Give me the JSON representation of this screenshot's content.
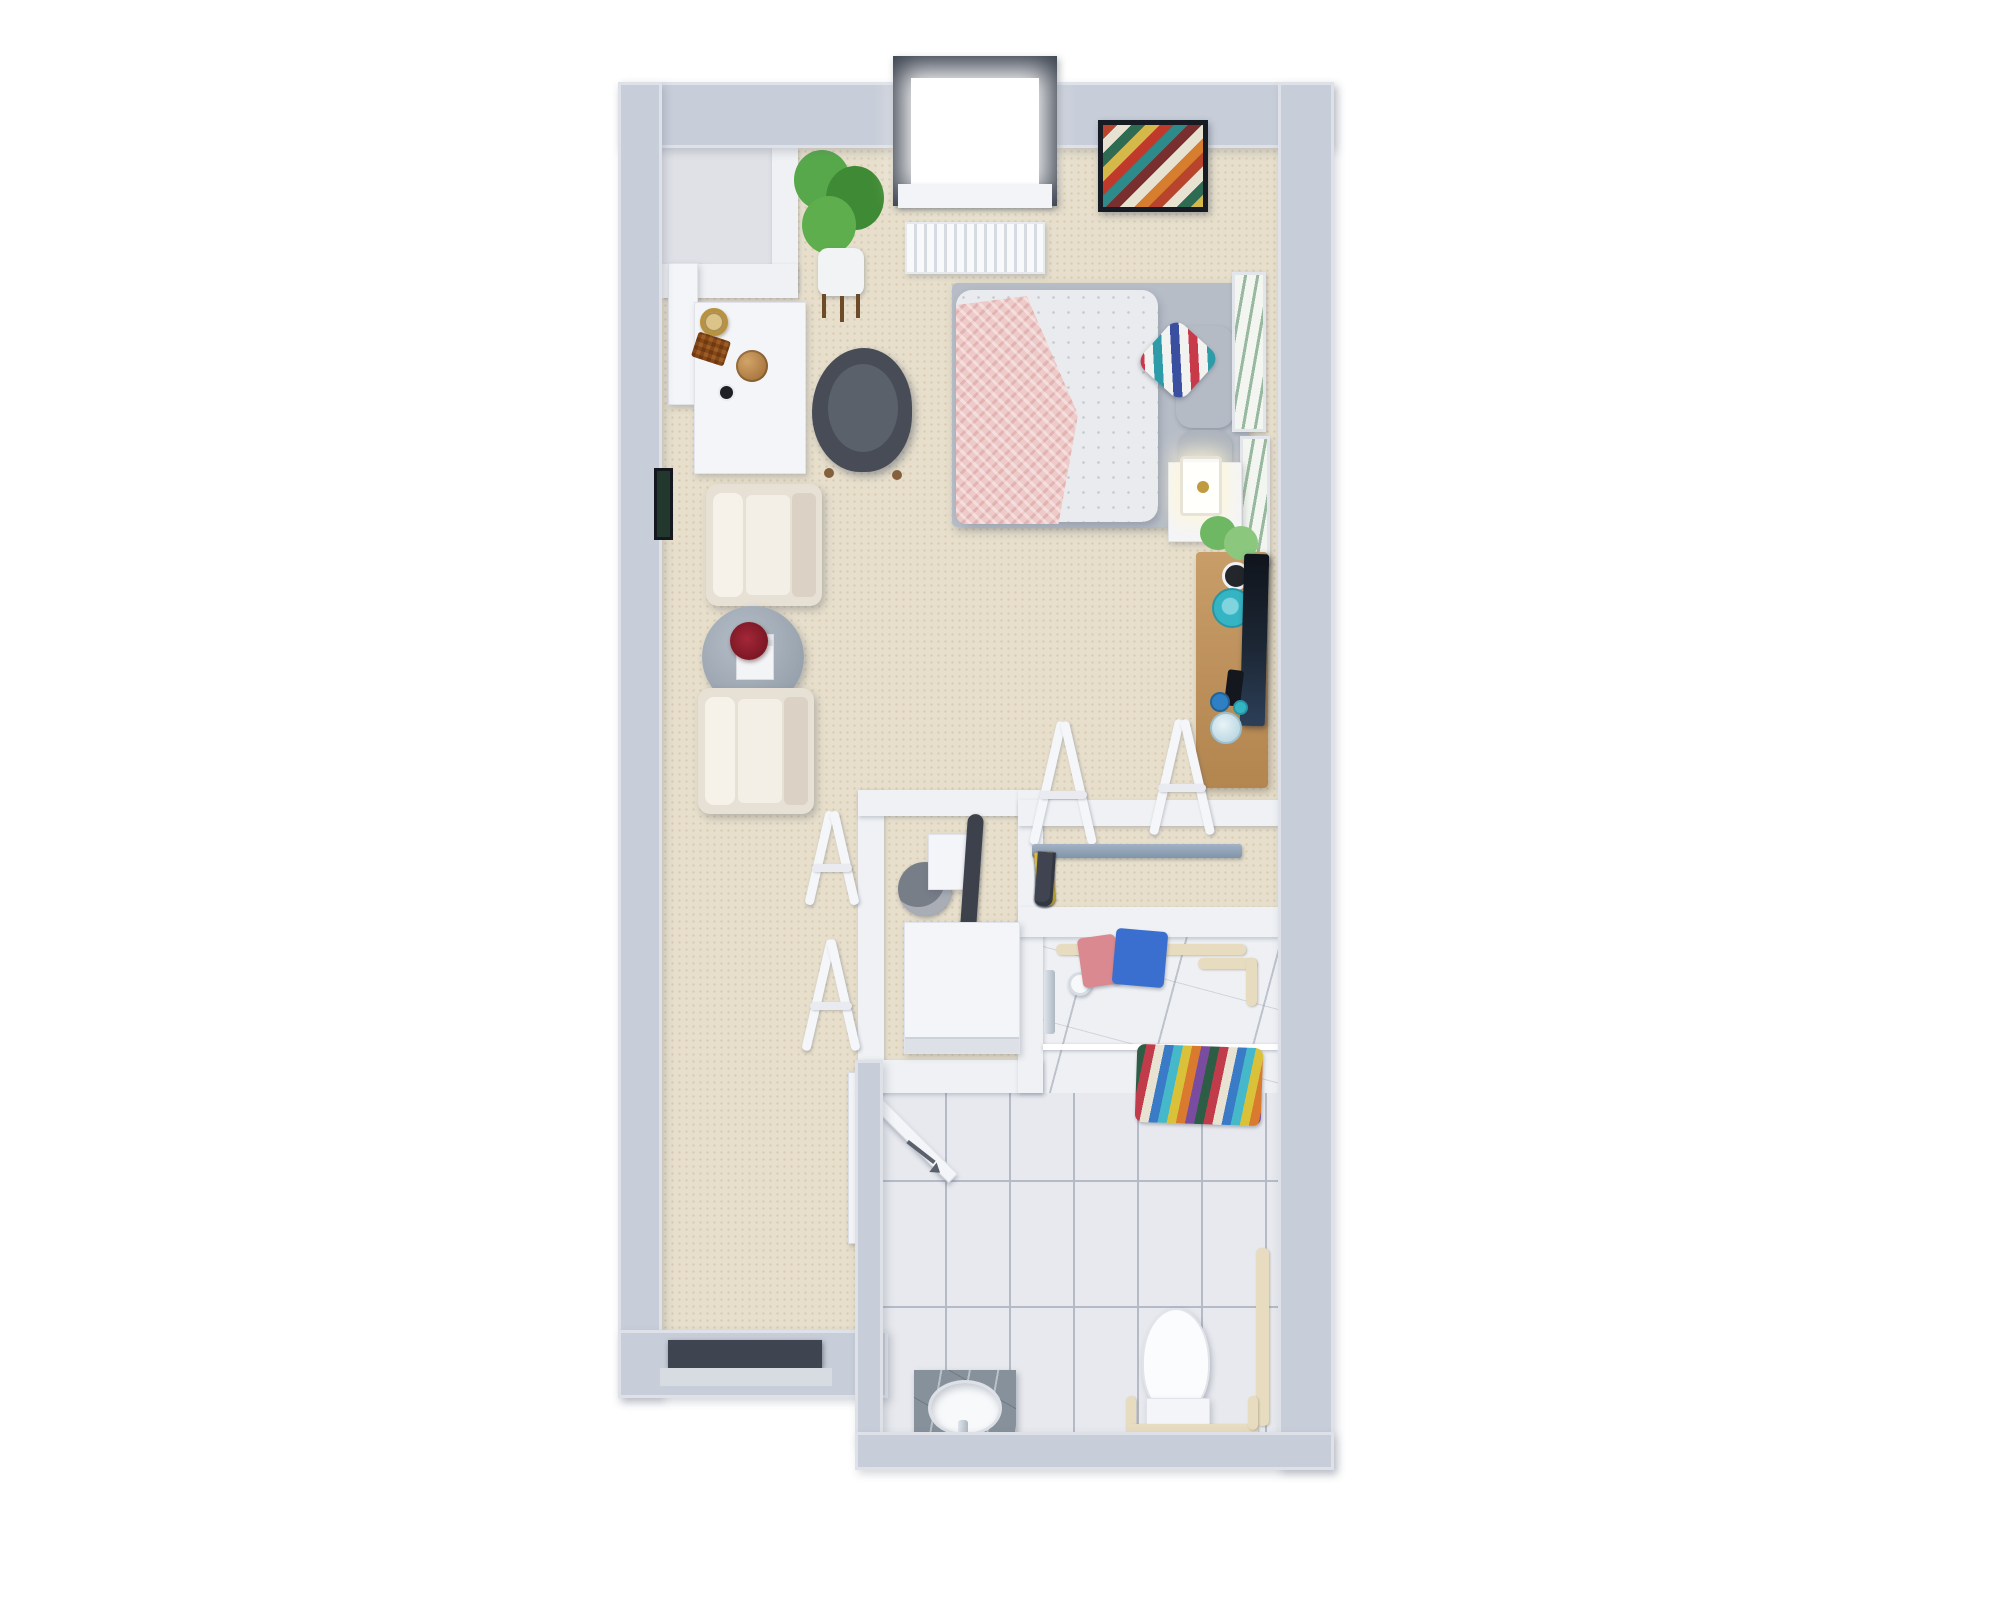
{
  "meta": {
    "title": "3D Studio Apartment Floor Plan",
    "view": "top-down 3D render, no visible text",
    "canvas": {
      "width": 2000,
      "height": 1600
    }
  },
  "palette": {
    "page-bg": "#ffffff",
    "wall": "#c8ced9",
    "wall-top": "#e9ebf0",
    "wall-white": "#eff1f4",
    "carpet": "#e7dfcc",
    "carpet-dot": "#d7cbb1",
    "nook-floor": "#dfe1e7",
    "tile": "#e7e9ee",
    "tile-joint": "#b4bac6",
    "marble": "#eef0f4",
    "wood": "#c2975f",
    "window-frame": "#39404d",
    "dark-door": "#3e4450",
    "teal": "#35b4c4",
    "blue": "#2f7fc4",
    "light-blue": "#cfe4ec",
    "pink-blanket": "#eecac8",
    "duvet": "#e9ebee",
    "gray-pillow": "#b5bbc5",
    "platform-gray": "#b7bdc7",
    "chair-dark": "#474c56",
    "cream-shell": "#e7e0d5",
    "cream-cushion": "#f4efe6",
    "flower-red": "#8e1f2c",
    "plant-green": "#4e9c40",
    "gold": "#b8923f",
    "white-furn": "#f4f5f8",
    "beige-bar": "#e8dcc0"
  },
  "rooms": [
    {
      "name": "Living & Sleeping Area",
      "floor": "beige carpet",
      "items": [
        "bed with dotted white duvet",
        "pink chunky-knit throw",
        "two gray pillows",
        "multicolor chevron accent pillow",
        "dark gray barrel armchair",
        "white desk",
        "brass basket",
        "woven brass tray",
        "bronze wire sphere",
        "black cup",
        "leaning mirror",
        "fiddle-leaf potted plant",
        "white panel radiator",
        "white nightstand",
        "brass lantern lamp",
        "wood media console",
        "flat-screen TV",
        "monstera plant",
        "teal plate",
        "blue vases",
        "light-blue jar",
        "cream lounge armchair x2",
        "round marble coffee table",
        "red flowers",
        "white book stack",
        "gallery wall of six dark botanical prints",
        "two white botanical prints on east wall"
      ]
    },
    {
      "name": "Entry Nook",
      "floor": "light gray",
      "items": [
        "white partition wall",
        "white ledge"
      ]
    },
    {
      "name": "Walk-in Closet",
      "floor": "beige carpet",
      "items": [
        "two white leaning garment racks",
        "gray hanging rod",
        "colorful hanging clothes"
      ]
    },
    {
      "name": "Laundry Closet",
      "floor": "beige carpet",
      "items": [
        "white washer-dryer",
        "gray round bin",
        "white cabinet",
        "dark ironing board",
        "two white folding racks outside"
      ]
    },
    {
      "name": "Bathroom",
      "floor": "white tile with marble shower",
      "items": [
        "marble walk-in shower",
        "glass shower screen",
        "handheld shower fixture",
        "towel rail with pink and blue towels",
        "striped serape towels on rod",
        "beige grab bars and towel bars",
        "gray marble vanity",
        "white oval sink",
        "chrome faucet",
        "white toilet",
        "beige toilet safety rail",
        "white hinged door",
        "door swing arrow mark"
      ]
    }
  ],
  "doors": {
    "apartment_entry": {
      "color": "#3e4450",
      "location": "south wall of living area"
    },
    "bathroom": {
      "color": "#f4f5f8",
      "state": "open, swings inward"
    }
  },
  "window": {
    "location": "north wall",
    "frame": "#39404d",
    "pane": "#ffffff"
  },
  "artwork": {
    "wall_art_chevron": {
      "frame": "#171c24",
      "colors": [
        "#b8442e",
        "#e8e2d2",
        "#2e6b52",
        "#d4b84a",
        "#c1392b",
        "#2e8b8b",
        "#7a2e2e",
        "#e8e2d2",
        "#d67d2e"
      ]
    },
    "gallery_wall_west": {
      "frame": "#14181e",
      "colors": [
        "#1e3a30",
        "#253c2f",
        "#182620",
        "#2c4a3a",
        "#1c2f26",
        "#22382c"
      ]
    },
    "botanical_prints_east": {
      "frame": "#e2e5ea",
      "bg": "#f2f5f0",
      "accent": "#3e7d4e",
      "count": 2
    }
  },
  "pillows": {
    "accent_stripes": [
      "#c8394a",
      "#f2f2f0",
      "#2e9ba8",
      "#f2f2f0",
      "#3a4fa0",
      "#f2f2f0"
    ]
  },
  "closet": {
    "garment_colors": [
      "#a9c93a",
      "#c23b4a",
      "#9fc23a",
      "#c8374d",
      "#45b9c9",
      "#c23b4a",
      "#b53043",
      "#d9c23a",
      "#3f4450"
    ]
  },
  "bathroom": {
    "rainbow_towel_stripes": [
      "#2e5d46",
      "#c23b4a",
      "#e8e2d2",
      "#3a7bc8",
      "#45b9c9",
      "#d9c23a",
      "#d97a2e",
      "#7a4ca0"
    ],
    "rail_towel_colors": [
      "#d9898f",
      "#3a6fd0"
    ]
  }
}
